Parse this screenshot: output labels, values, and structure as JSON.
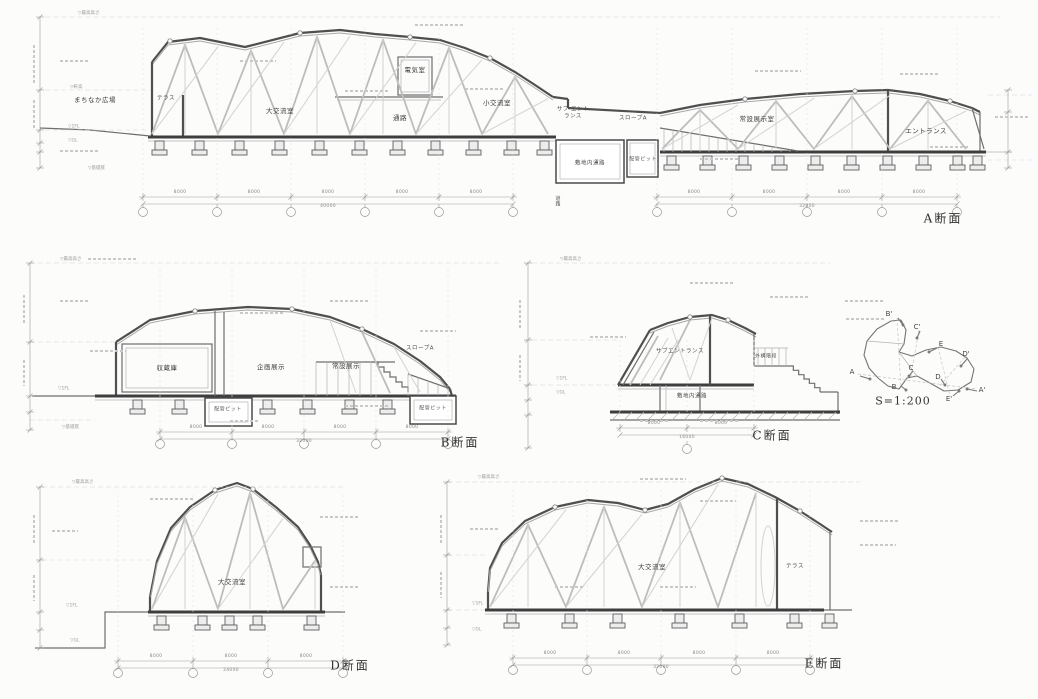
{
  "titles": {
    "a": "A断面",
    "b": "B断面",
    "c": "C断面",
    "d": "D断面",
    "e": "E断面"
  },
  "keyplan": {
    "scale": "S=1:200",
    "markers": {
      "a": "A",
      "a2": "A'",
      "b": "B",
      "b2": "B'",
      "c": "C",
      "c2": "C'",
      "d": "D",
      "d2": "D'",
      "e": "E",
      "e2": "E'"
    }
  },
  "rooms": {
    "a": {
      "plaza": "まちなか広場",
      "terrace": "テラス",
      "large_hall": "大交流室",
      "electrical": "電気室",
      "corridor": "通路",
      "small_hall": "小交流室",
      "sub_entrance": "サブ エントランス",
      "slope_a": "スロープA",
      "permanent_exhibit": "常設展示室",
      "entrance": "エントランス",
      "site_passage": "敷地内通路",
      "pipe_pit": "配管ピット",
      "road": "道路"
    },
    "b": {
      "storage": "収蔵庫",
      "planned_exhibit": "企画展示",
      "permanent_exhibit": "常設展示",
      "slope_a": "スロープA",
      "pipe_pit_left": "配管ピット",
      "pipe_pit_right": "配管ピット"
    },
    "c": {
      "sub_entrance": "サブエントランス",
      "site_passage": "敷地内通路",
      "ext_stairs": "外構階段"
    },
    "d": {
      "large_hall": "大交流室"
    },
    "e": {
      "large_hall": "大交流室",
      "terrace": "テラス"
    }
  },
  "levels": {
    "top": "▽最高高さ",
    "eaves": "▽軒高",
    "fl1": "▽1FL",
    "gl": "▽GL",
    "base": "▽基礎底"
  },
  "dims": {
    "a_left": {
      "segs": [
        "8000",
        "8000",
        "8000",
        "8000",
        "8000"
      ],
      "total": "40000"
    },
    "a_right": {
      "segs": [
        "8000",
        "8000",
        "8000",
        "8000"
      ],
      "total": "32000"
    },
    "b": {
      "segs": [
        "8000",
        "8000",
        "8000",
        "8000"
      ],
      "total": "32000"
    },
    "c": {
      "segs": [
        "8000",
        "8000"
      ],
      "total": "16000"
    },
    "d": {
      "segs": [
        "8000",
        "8000",
        "8000"
      ],
      "total": "24000"
    },
    "e": {
      "segs": [
        "8000",
        "8000",
        "8000",
        "8000"
      ],
      "total": "32000"
    }
  }
}
